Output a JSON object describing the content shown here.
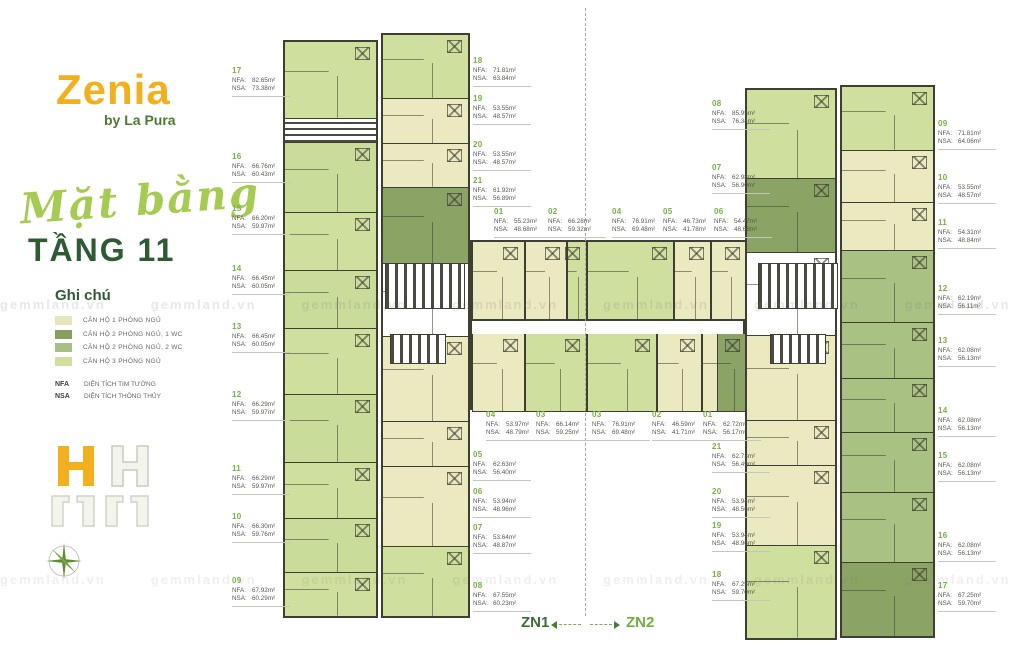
{
  "branding": {
    "name": "Zenia",
    "byline": "by La Pura"
  },
  "title": {
    "script": "Mặt bằng",
    "floor": "TẦNG 11"
  },
  "legend": {
    "title": "Ghi chú",
    "items": [
      {
        "label": "CĂN HỘ 1 PHÒNG NGỦ",
        "color": "#e6e6bd"
      },
      {
        "label": "CĂN HỘ 2 PHÒNG NGỦ, 1 WC",
        "color": "#879f63"
      },
      {
        "label": "CĂN HỘ 2 PHÒNG NGỦ, 2 WC",
        "color": "#a6bf82"
      },
      {
        "label": "CĂN HỘ 3 PHÒNG NGỦ",
        "color": "#cfe09e"
      }
    ],
    "notes": [
      {
        "abbr": "NFA",
        "label": "DIỆN TÍCH TIM TƯỜNG"
      },
      {
        "abbr": "NSA",
        "label": "DIỆN TÍCH THÔNG THỦY"
      }
    ]
  },
  "field_labels": {
    "nfa": "NFA:",
    "nsa": "NSA:"
  },
  "zones": {
    "left": "ZN1",
    "right": "ZN2"
  },
  "watermark": "gemmland.vn",
  "units": {
    "zn1": {
      "01": {
        "nfa": "55.23m²",
        "nsa": "48.68m²"
      },
      "02": {
        "nfa": "66.28m²",
        "nsa": "59.32m²"
      },
      "03": {
        "nfa": "66.14m²",
        "nsa": "59.25m²"
      },
      "04": {
        "nfa": "53.97m²",
        "nsa": "48.79m²"
      },
      "05": {
        "nfa": "62.63m²",
        "nsa": "56.40m²"
      },
      "06": {
        "nfa": "53.94m²",
        "nsa": "48.96m²"
      },
      "07": {
        "nfa": "53.64m²",
        "nsa": "48.87m²"
      },
      "08": {
        "nfa": "67.55m²",
        "nsa": "60.23m²"
      },
      "09": {
        "nfa": "67.92m²",
        "nsa": "60.29m²"
      },
      "10": {
        "nfa": "66.30m²",
        "nsa": "59.76m²"
      },
      "11": {
        "nfa": "66.29m²",
        "nsa": "59.97m²"
      },
      "12": {
        "nfa": "66.29m²",
        "nsa": "59.97m²"
      },
      "13": {
        "nfa": "66.45m²",
        "nsa": "60.05m²"
      },
      "14": {
        "nfa": "66.45m²",
        "nsa": "60.05m²"
      },
      "15": {
        "nfa": "66.20m²",
        "nsa": "59.97m²"
      },
      "16": {
        "nfa": "66.76m²",
        "nsa": "60.43m²"
      },
      "17": {
        "nfa": "82.65m²",
        "nsa": "73.38m²"
      },
      "18": {
        "nfa": "71.81m²",
        "nsa": "63.84m²"
      },
      "19": {
        "nfa": "53.55m²",
        "nsa": "48.57m²"
      },
      "20": {
        "nfa": "53.55m²",
        "nsa": "48.57m²"
      },
      "21": {
        "nfa": "61.92m²",
        "nsa": "56.89m²"
      }
    },
    "zn2": {
      "01": {
        "nfa": "62.72m²",
        "nsa": "56.17m²"
      },
      "02": {
        "nfa": "46.59m²",
        "nsa": "41.71m²"
      },
      "03": {
        "nfa": "76.91m²",
        "nsa": "69.48m²"
      },
      "04": {
        "nfa": "76.91m²",
        "nsa": "69.48m²"
      },
      "05": {
        "nfa": "46.73m²",
        "nsa": "41.78m²"
      },
      "06": {
        "nfa": "54.47m²",
        "nsa": "48.68m²"
      },
      "07": {
        "nfa": "62.98m²",
        "nsa": "56.90m²"
      },
      "08": {
        "nfa": "85.95m²",
        "nsa": "76.34m²"
      },
      "09": {
        "nfa": "71.81m²",
        "nsa": "64.06m²"
      },
      "10": {
        "nfa": "53.55m²",
        "nsa": "48.57m²"
      },
      "11": {
        "nfa": "54.31m²",
        "nsa": "48.84m²"
      },
      "12": {
        "nfa": "62.19m²",
        "nsa": "56.11m²"
      },
      "13": {
        "nfa": "62.08m²",
        "nsa": "56.13m²"
      },
      "14": {
        "nfa": "62.08m²",
        "nsa": "56.13m²"
      },
      "15": {
        "nfa": "62.08m²",
        "nsa": "56.13m²"
      },
      "16": {
        "nfa": "62.08m²",
        "nsa": "56.13m²"
      },
      "17": {
        "nfa": "67.25m²",
        "nsa": "59.70m²"
      },
      "18": {
        "nfa": "67.25m²",
        "nsa": "59.70m²"
      },
      "19": {
        "nfa": "53.94m²",
        "nsa": "48.96m²"
      },
      "20": {
        "nfa": "53.94m²",
        "nsa": "48.56m²"
      },
      "21": {
        "nfa": "62.73m²",
        "nsa": "56.49m²"
      }
    }
  }
}
